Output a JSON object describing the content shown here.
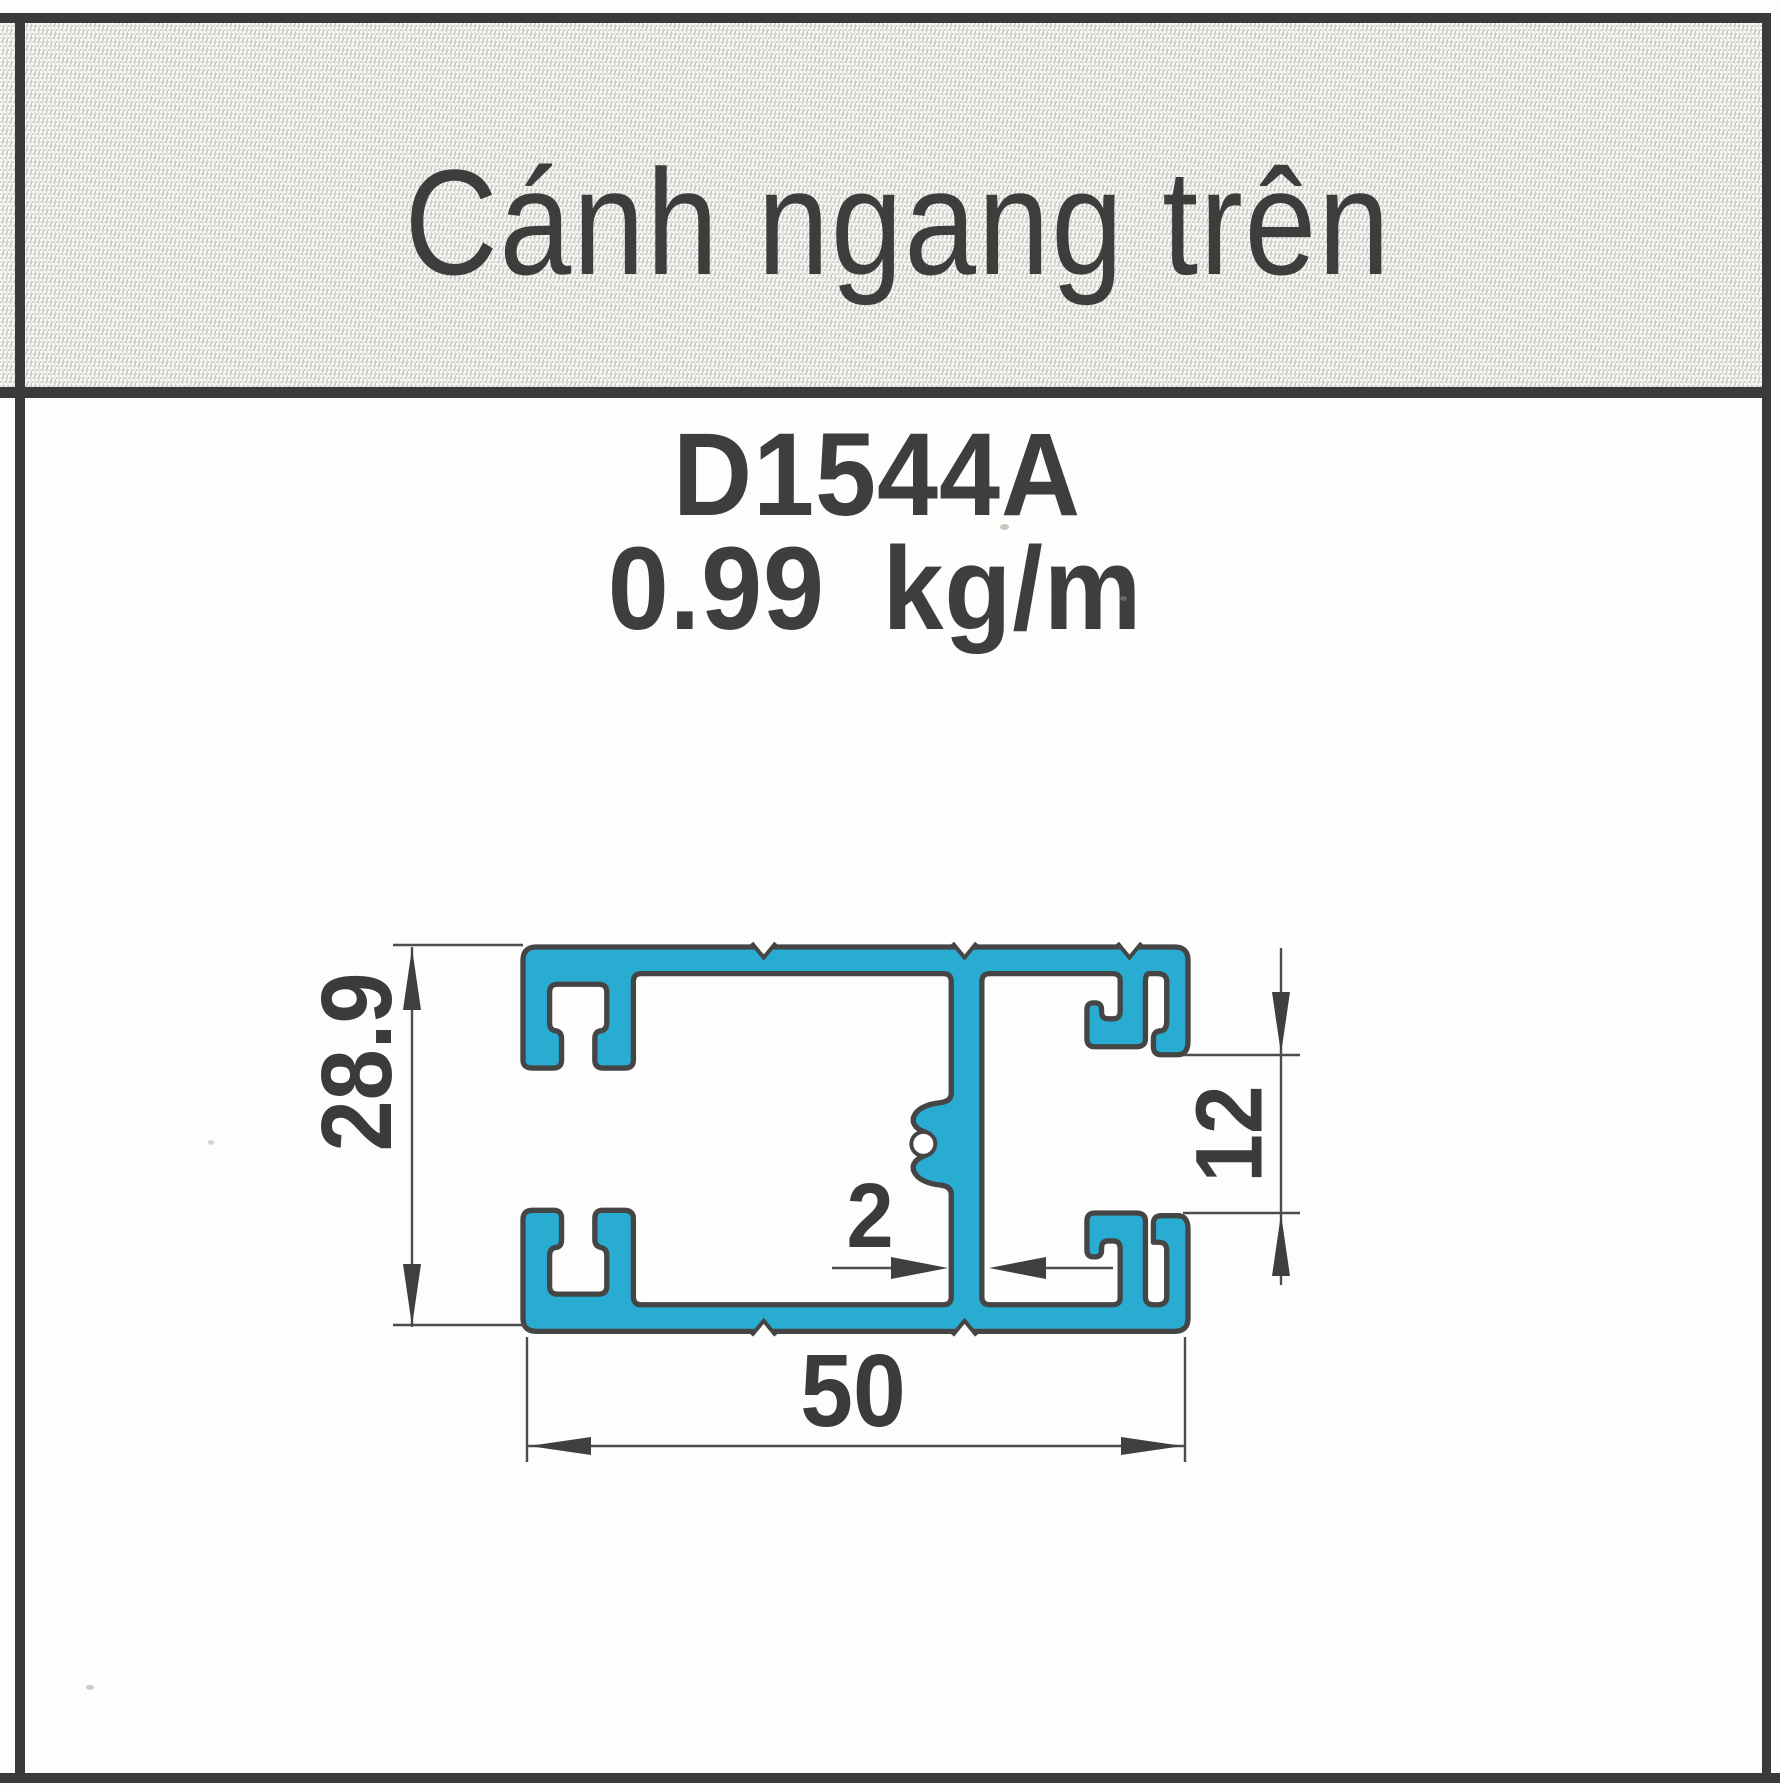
{
  "header": {
    "title": "Cánh ngang trên"
  },
  "product": {
    "code": "D1544A",
    "weight": "0.99 kg/m"
  },
  "drawing": {
    "type": "aluminium-profile-cross-section",
    "profile_fill_color": "#29acd2",
    "outline_color": "#454545",
    "dimensions": {
      "overall_height_mm": "28.9",
      "right_opening_mm": "12",
      "wall_thickness_mm": "2",
      "overall_width_mm": "50"
    }
  }
}
